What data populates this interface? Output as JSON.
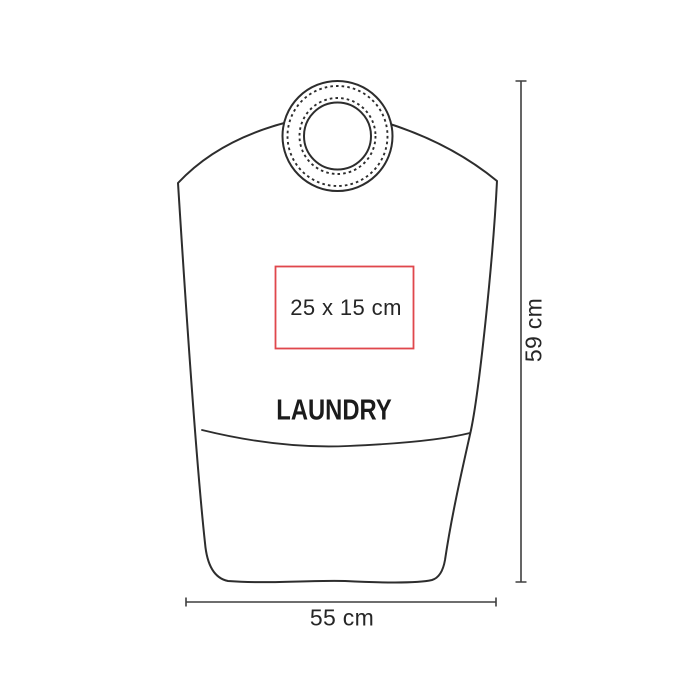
{
  "diagram": {
    "type": "laundry-bag-print-area-mockup",
    "product_label": "LAUNDRY",
    "print_area": {
      "size_label": "25 x 15 cm"
    },
    "dimensions": {
      "width_label": "55 cm",
      "height_label": "59 cm"
    }
  },
  "colors": {
    "print_area_border": "#e0474c",
    "outline": "#2d2d2d",
    "dimension_line": "#3f3f3f",
    "text": "#262626",
    "background": "#ffffff"
  }
}
